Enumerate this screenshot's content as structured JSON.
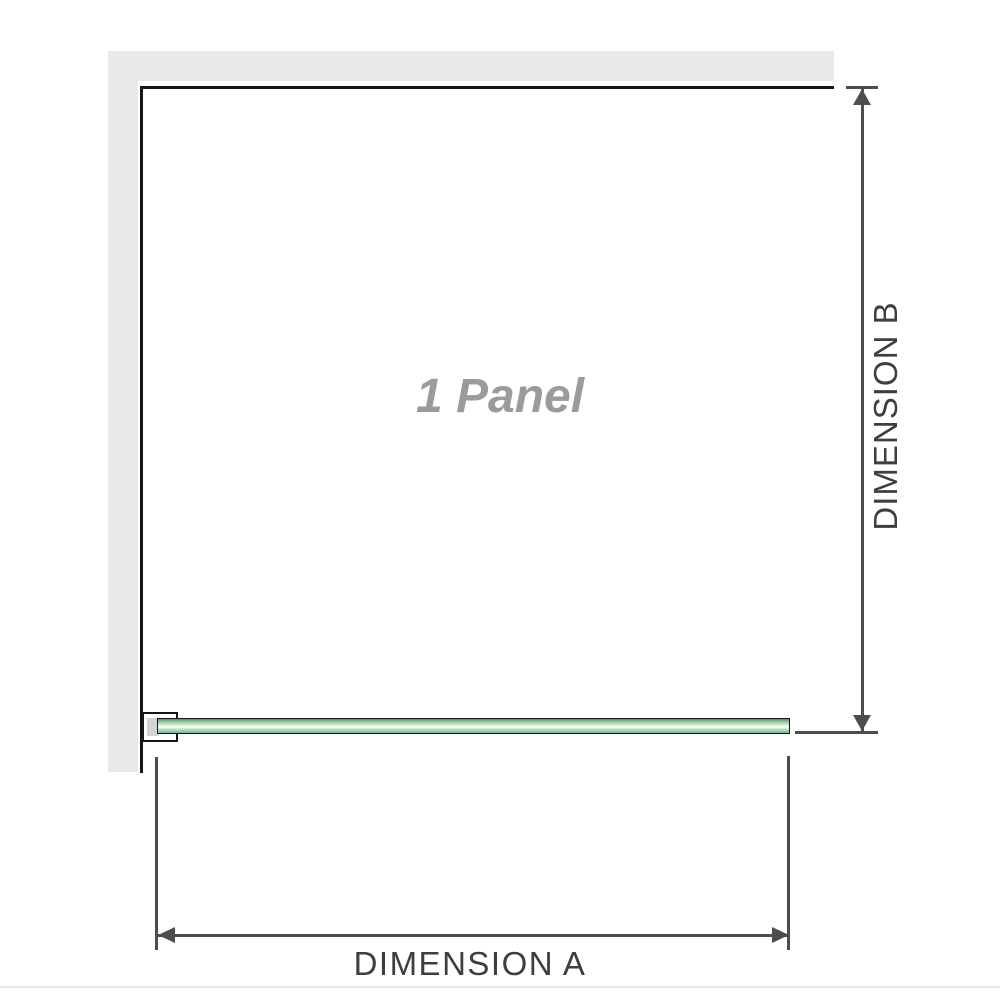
{
  "diagram": {
    "panel_label": "1 Panel",
    "dimension_a": {
      "label": "DIMENSION A"
    },
    "dimension_b": {
      "label": "DIMENSION B"
    },
    "colors": {
      "wall": "#e9e9e9",
      "panel_border": "#161616",
      "dimension_line": "#4b4e51",
      "dimension_text": "#3c3e41",
      "panel_label_text": "#9b9b9b",
      "bracket_block": "#d3d3d3",
      "glass_edge": "#161616",
      "glass_green_dark": "#4f9464",
      "glass_green_mid": "#9bd0ab",
      "glass_green_light": "#f3fbf5",
      "separator": "#e8e6e2"
    }
  }
}
